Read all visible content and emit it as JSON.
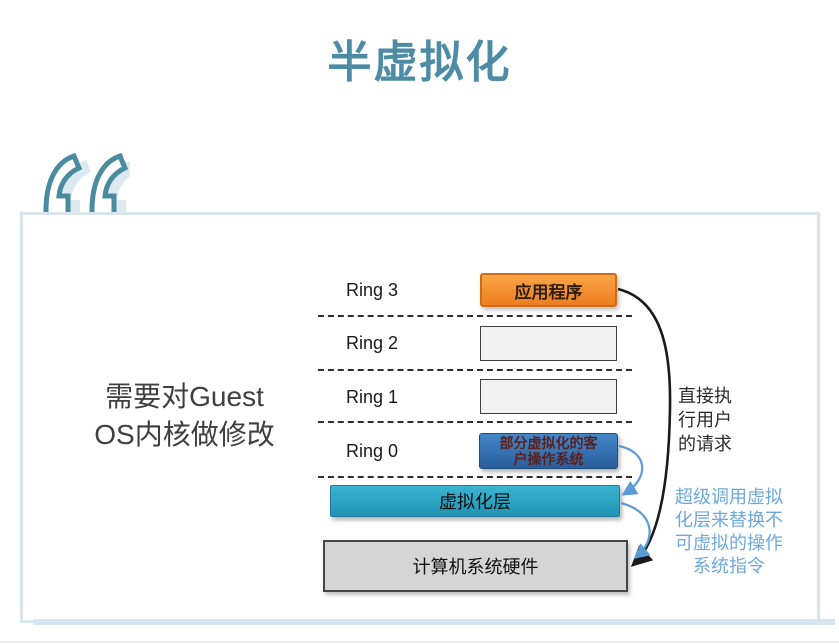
{
  "slide": {
    "title": "半虚拟化"
  },
  "quote": {
    "icon": "double-quote"
  },
  "panel": {
    "note_lines": [
      "需要对Guest",
      "OS内核做修改"
    ]
  },
  "diagram": {
    "rings": [
      {
        "label": "Ring 3"
      },
      {
        "label": "Ring 2"
      },
      {
        "label": "Ring 1"
      },
      {
        "label": "Ring 0"
      }
    ],
    "boxes": {
      "application": {
        "label": "应用程序"
      },
      "guest_os": {
        "lines": [
          "部分虚拟化的客",
          "户操作系统"
        ]
      },
      "virtualization_layer": {
        "label": "虚拟化层"
      },
      "hardware": {
        "label": "计算机系统硬件"
      }
    },
    "annotations": {
      "direct_execution": {
        "lines": [
          "直接执",
          "行用户",
          "的请求"
        ]
      },
      "hypercall": {
        "lines": [
          "超级调用虚拟",
          "化层来替换不",
          "可虚拟的操作",
          "系统指令"
        ]
      }
    }
  },
  "colors": {
    "title": "#4e8ca6",
    "quote_mark": "#4a8ba0",
    "quote_shadow": "#dde9f0",
    "frame_border": "#d9e5ee",
    "application_box": "#ef8220",
    "guest_os_box": "#3576b5",
    "guest_os_text": "#5b2120",
    "virtualization_layer_box": "#2aa3c2",
    "hardware_box": "#d5d5d5",
    "direct_execution_text": "#2b2b2b",
    "hypercall_text": "#6fa8dc",
    "arrow_black": "#1a1a1a",
    "arrow_blue": "#5b9bd5"
  }
}
